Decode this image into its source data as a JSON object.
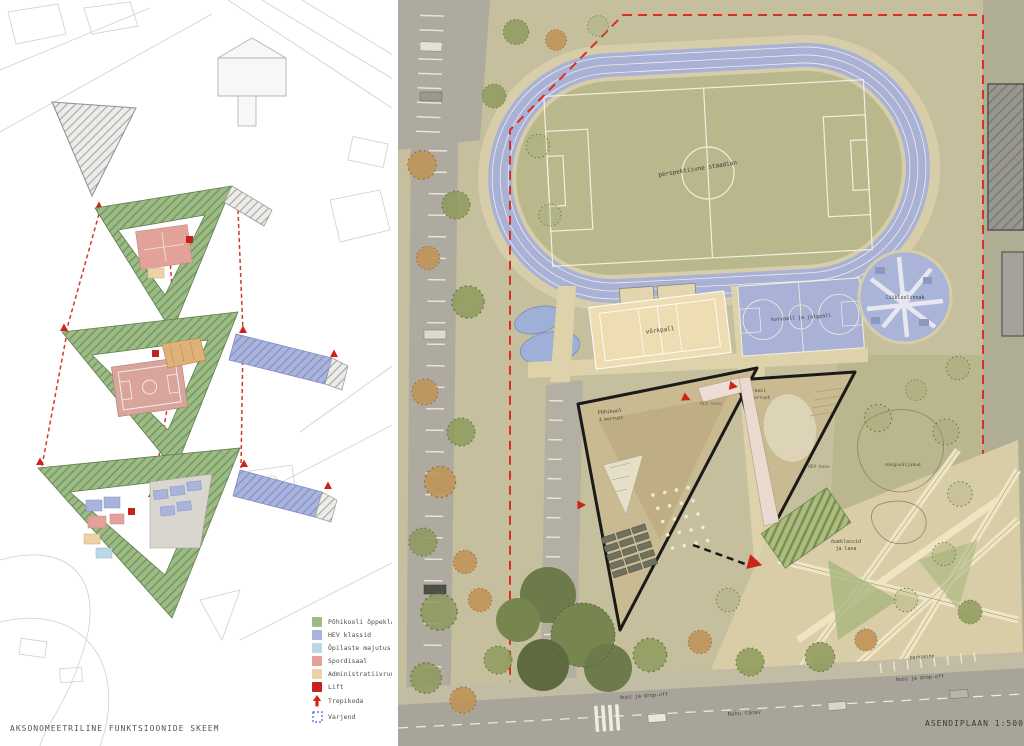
{
  "left_panel": {
    "caption": "AKSONOMEETRILINE FUNKTSIOONIDE SKEEM",
    "legend": [
      {
        "label": "Põhikooli õppeklassid",
        "swatch": "#9dbb84",
        "kind": "fill"
      },
      {
        "label": "HEV klassid",
        "swatch": "#aab3dc",
        "kind": "fill"
      },
      {
        "label": "Õpilaste majutus",
        "swatch": "#bcd8e4",
        "kind": "fill"
      },
      {
        "label": "Spordisaal",
        "swatch": "#e2a29a",
        "kind": "fill"
      },
      {
        "label": "Administratiivruumid",
        "swatch": "#ecd2a6",
        "kind": "fill"
      },
      {
        "label": "Lift",
        "swatch": "#c8201a",
        "kind": "fill"
      },
      {
        "label": "Trepikoda",
        "swatch": "#cc2418",
        "kind": "stair-arrow"
      },
      {
        "label": "Varjend",
        "swatch": "#4b5fd0",
        "kind": "dashed-outline"
      }
    ]
  },
  "site_plan": {
    "caption": "ASENDIPLAAN 1:500",
    "labels": {
      "stadium": "perspektiivne staadion",
      "volleyball": "võrkpall",
      "basketball": "korvpall ja jalgpall",
      "traffic_town": "liikluslinnak",
      "playgrounds": "mänguväljakud",
      "main_school_line1": "Põhikool",
      "main_school_line2": "3 korrust",
      "hev_school_line1": "HEV-kool",
      "hev_school_line2": "2 korrust",
      "hev_yard_upper": "HEV-hoov",
      "hev_yard_lower": "HEV-hoov",
      "outdoor_classes_line1": "õueklassid",
      "outdoor_classes_line2": "ja lava",
      "bus_dropoff_left": "buss ja drop-off",
      "bus_dropoff_right": "buss ja drop-off",
      "street": "Rahu tänav",
      "parking": "parkimine"
    },
    "colors": {
      "boundary_red": "#d93025",
      "track_blue": "#a9b2d6",
      "pitch_green": "#b8b88c",
      "roof_tan": "#c9ba92"
    }
  }
}
